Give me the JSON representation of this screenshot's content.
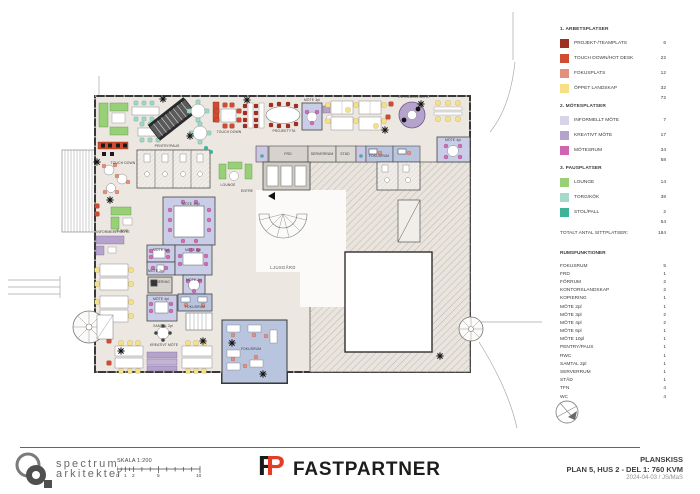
{
  "sheet": {
    "doc_type": "PLANSKISS"
  },
  "plan": {
    "palette": {
      "projekt_teamplats": "#9e2f23",
      "touch_down_hot_desk": "#cf4b31",
      "fokusplats": "#e4907e",
      "oppet_landskap": "#f6df85",
      "informellt_mote": "#d9d3e8",
      "kreativt_mote": "#b5a3cc",
      "motesrum": "#ce66b0",
      "lounge": "#97d077",
      "torg_kok": "#a4d9cb",
      "stol_pall": "#3fb39a",
      "floor": "#ece7e1",
      "wall": "#3a3a3a",
      "meeting_room_fill": "#c9cde7",
      "fokusrum_fill": "#b9c4de"
    },
    "labels": [
      {
        "text": "PENTRY/PAUS",
        "x": 167,
        "y": 147
      },
      {
        "text": "TOUCH DOWN",
        "x": 123,
        "y": 164
      },
      {
        "text": "TOUCH DOWN",
        "x": 229,
        "y": 133
      },
      {
        "text": "LOUNGE",
        "x": 228,
        "y": 186
      },
      {
        "text": "LOUNGE",
        "x": 121,
        "y": 232
      },
      {
        "text": "INFORMELLT MÖTE",
        "x": 113,
        "y": 233
      },
      {
        "text": "ENTRE",
        "x": 247,
        "y": 192
      },
      {
        "text": "LJUSGÅRD",
        "x": 283,
        "y": 269,
        "big": true
      },
      {
        "text": "FRD",
        "x": 288,
        "y": 155
      },
      {
        "text": "SERVERRUM",
        "x": 322,
        "y": 155
      },
      {
        "text": "STÄD",
        "x": 345,
        "y": 155
      },
      {
        "text": "FOKUSRUM",
        "x": 379,
        "y": 157
      },
      {
        "text": "MÖTE 10pl",
        "x": 191,
        "y": 205
      },
      {
        "text": "MÖTE 4pl",
        "x": 161,
        "y": 251
      },
      {
        "text": "MÖTE 6pl",
        "x": 193,
        "y": 251
      },
      {
        "text": "MÖTE 2pl",
        "x": 156,
        "y": 272
      },
      {
        "text": "KOPIERING",
        "x": 160,
        "y": 283
      },
      {
        "text": "MÖTE 3pl",
        "x": 194,
        "y": 281
      },
      {
        "text": "MÖTE 4pl",
        "x": 161,
        "y": 300
      },
      {
        "text": "FOKUSRUM",
        "x": 195,
        "y": 308
      },
      {
        "text": "KREATIVT MÖTE",
        "x": 164,
        "y": 346
      },
      {
        "text": "FOKUSRUM",
        "x": 251,
        "y": 350
      },
      {
        "text": "MÖTE 3pl",
        "x": 312,
        "y": 101
      },
      {
        "text": "MÖTE 4pl",
        "x": 453,
        "y": 141
      },
      {
        "text": "INFORMELL MÖTE",
        "x": 414,
        "y": 98
      },
      {
        "text": "PROJEKTYTA",
        "x": 284,
        "y": 132
      },
      {
        "text": "SAMTAL 2pl",
        "x": 163,
        "y": 327
      }
    ]
  },
  "legend": {
    "sections": [
      {
        "title": "1. ARBETSPLATSER",
        "items": [
          {
            "label": "PROJEKT-/TEAMPLATS",
            "count": "6",
            "color": "#9e2f23"
          },
          {
            "label": "TOUCH DOWN/HOT DESK",
            "count": "22",
            "color": "#cf4b31"
          },
          {
            "label": "FOKUSPLATS",
            "count": "12",
            "color": "#e4907e"
          },
          {
            "label": "ÖPPET LANDSKAP",
            "count": "32",
            "color": "#f6df85"
          }
        ],
        "subtotal": "72"
      },
      {
        "title": "2. MÖTESPLATSER",
        "items": [
          {
            "label": "INFORMELLT MÖTE",
            "count": "7",
            "color": "#d9d3e8"
          },
          {
            "label": "KREATIVT MÖTE",
            "count": "17",
            "color": "#b5a3cc"
          },
          {
            "label": "MÖTESRUM",
            "count": "34",
            "color": "#ce66b0"
          }
        ],
        "subtotal": "58"
      },
      {
        "title": "3. PAUSPLATSER",
        "items": [
          {
            "label": "LOUNGE",
            "count": "14",
            "color": "#97d077"
          },
          {
            "label": "TORG/KÖK",
            "count": "38",
            "color": "#a4d9cb"
          },
          {
            "label": "STOL/PALL",
            "count": "2",
            "color": "#3fb39a"
          }
        ],
        "subtotal": "54"
      }
    ],
    "total_label": "TOTALT ANTAL SITTPLATSER:",
    "total_value": "184"
  },
  "room_functions": {
    "title": "RUMSFUNKTIONER",
    "rows": [
      {
        "label": "FOKUSRUM",
        "count": "5"
      },
      {
        "label": "FRD",
        "count": "1"
      },
      {
        "label": "FÖRRUM",
        "count": "2"
      },
      {
        "label": "KONTORSLANDSKAP",
        "count": "2"
      },
      {
        "label": "KOPIERING",
        "count": "1"
      },
      {
        "label": "MÖTE 2pl",
        "count": "1"
      },
      {
        "label": "MÖTE 3pl",
        "count": "2"
      },
      {
        "label": "MÖTE 4pl",
        "count": "2"
      },
      {
        "label": "MÖTE 6pl",
        "count": "1"
      },
      {
        "label": "MÖTE 10pl",
        "count": "1"
      },
      {
        "label": "PENTRY/PAUS",
        "count": "1"
      },
      {
        "label": "RWC",
        "count": "1"
      },
      {
        "label": "SAMTAL 2pl",
        "count": "1"
      },
      {
        "label": "SERVERRUM",
        "count": "1"
      },
      {
        "label": "STÄD",
        "count": "1"
      },
      {
        "label": "TFN",
        "count": "4"
      },
      {
        "label": "WC",
        "count": "4"
      }
    ]
  },
  "footer": {
    "brand": {
      "line1": "spectrum",
      "line2": "arkitekter"
    },
    "scale": {
      "label": "SKALA 1:200",
      "ticks": [
        "0",
        "1",
        "2",
        "5",
        "10"
      ]
    },
    "client": {
      "monogram_f": "F",
      "monogram_p": "P",
      "name": "FASTPARTNER"
    },
    "title_block": {
      "doc_type": "PLANSKISS",
      "plan_title": "PLAN 5, HUS 2 - DEL 1: 760 KVM",
      "date_sig": "2024-04-03 / JS/MaS"
    }
  }
}
